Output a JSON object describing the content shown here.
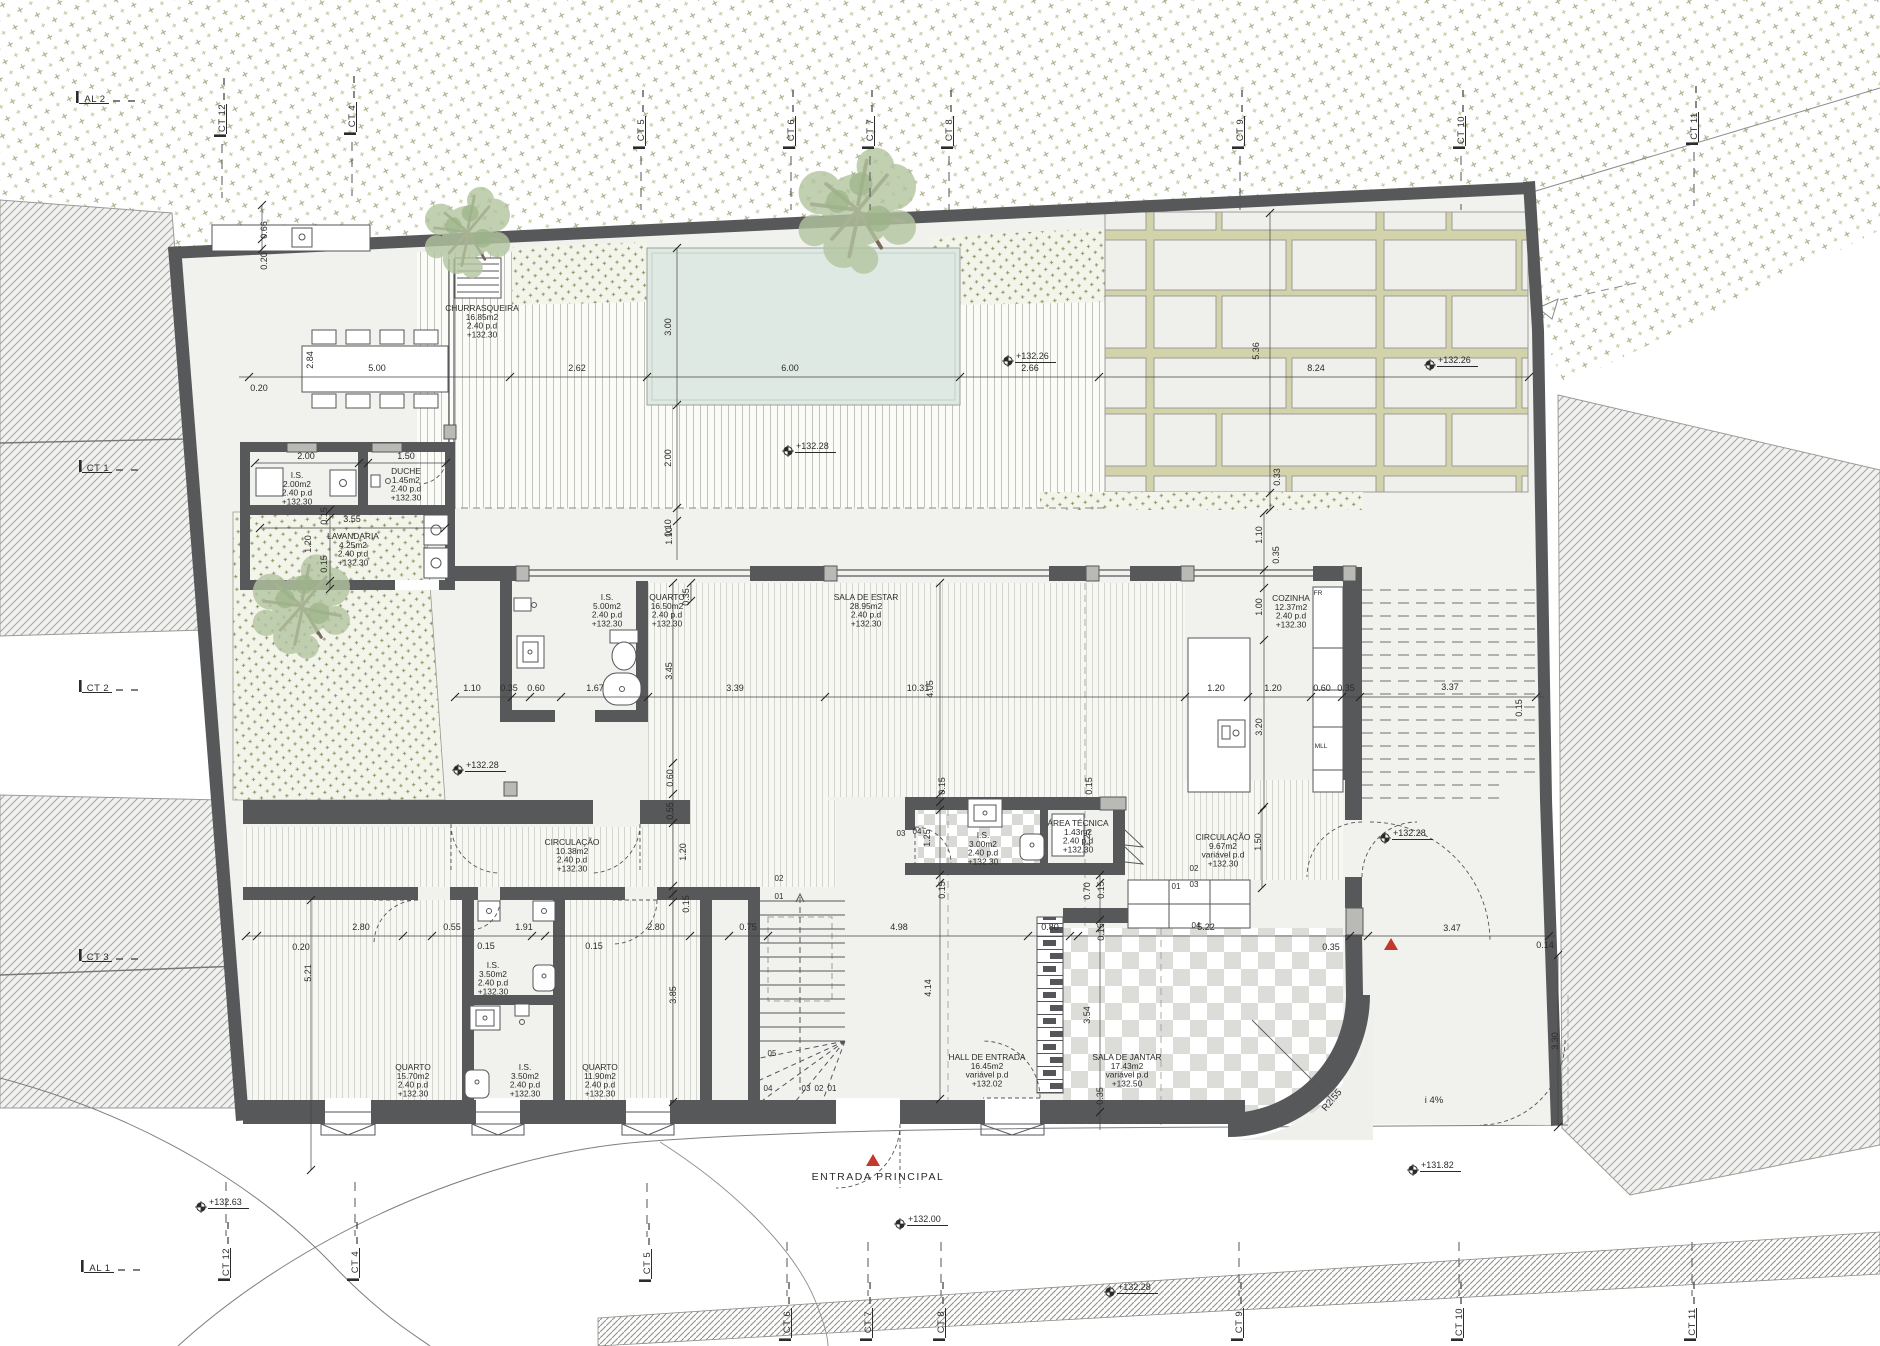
{
  "drawing": {
    "kind": "architectural floor plan",
    "entrance_label": "ENTRADA PRINCIPAL",
    "ramp_slope_label": "i 4%",
    "radius_label": "R2.55"
  },
  "colors": {
    "wall": "#57585a",
    "wall_light": "#b9b9b6",
    "pool": "#dfe9e3",
    "plot_floor": "#f1f1ee",
    "stipple_green": "#8f9465",
    "red_marker": "#c0392b",
    "checker": "#dcdcd8"
  },
  "rooms": [
    {
      "n": "CHURRASQUEIRA",
      "a": "16.85m2",
      "h": "2.40  p.d",
      "l": "+132.30",
      "x": 482,
      "y": 311
    },
    {
      "n": "I.S.",
      "a": "2.00m2",
      "h": "2.40  p.d",
      "l": "+132.30",
      "x": 297,
      "y": 478
    },
    {
      "n": "DUCHE",
      "a": "1.45m2",
      "h": "2.40  p.d",
      "l": "+132.30",
      "x": 406,
      "y": 474
    },
    {
      "n": "LAVANDARIA",
      "a": "4.25m2",
      "h": "2.40  p.d",
      "l": "+132.30",
      "x": 353,
      "y": 539
    },
    {
      "n": "I.S.",
      "a": "5.00m2",
      "h": "2.40  p.d",
      "l": "+132.30",
      "x": 607,
      "y": 600
    },
    {
      "n": "QUARTO",
      "a": "16.50m2",
      "h": "2.40  p.d",
      "l": "+132.30",
      "x": 667,
      "y": 600
    },
    {
      "n": "SALA DE ESTAR",
      "a": "28.95m2",
      "h": "2.40  p.d",
      "l": "+132.30",
      "x": 866,
      "y": 600
    },
    {
      "n": "COZINHA",
      "a": "12.37m2",
      "h": "2.40  p.d",
      "l": "+132.30",
      "x": 1291,
      "y": 601
    },
    {
      "n": "CIRCULAÇÃO",
      "a": "10.38m2",
      "h": "2.40  p.d",
      "l": "+132.30",
      "x": 572,
      "y": 845
    },
    {
      "n": "I.S.",
      "a": "3.00m2",
      "h": "2.40  p.d",
      "l": "+132.30",
      "x": 983,
      "y": 838
    },
    {
      "n": "ÁREA TÉCNICA",
      "a": "1.43m2",
      "h": "2.40  p.d",
      "l": "+132.30",
      "x": 1078,
      "y": 826
    },
    {
      "n": "CIRCULAÇÃO",
      "a": "9.67m2",
      "h": "variável  p.d",
      "l": "+132.30",
      "x": 1223,
      "y": 840
    },
    {
      "n": "QUARTO",
      "a": "15.70m2",
      "h": "2.40  p.d",
      "l": "+132.30",
      "x": 413,
      "y": 1070
    },
    {
      "n": "I.S.",
      "a": "3.50m2",
      "h": "2.40  p.d",
      "l": "+132.30",
      "x": 493,
      "y": 968
    },
    {
      "n": "I.S.",
      "a": "3.50m2",
      "h": "2.40  p.d",
      "l": "+132.30",
      "x": 525,
      "y": 1070
    },
    {
      "n": "QUARTO",
      "a": "11.90m2",
      "h": "2.40  p.d",
      "l": "+132.30",
      "x": 600,
      "y": 1070
    },
    {
      "n": "HALL DE ENTRADA",
      "a": "16.45m2",
      "h": "variável  p.d",
      "l": "+132.02",
      "x": 987,
      "y": 1060
    },
    {
      "n": "SALA DE JANTAR",
      "a": "17.43m2",
      "h": "variável  p.d",
      "l": "+132.50",
      "x": 1127,
      "y": 1060
    }
  ],
  "levels": [
    {
      "t": "+132.26",
      "x": 1008,
      "y": 361
    },
    {
      "t": "+132.26",
      "x": 1430,
      "y": 365
    },
    {
      "t": "+132.28",
      "x": 788,
      "y": 451
    },
    {
      "t": "+132.28",
      "x": 458,
      "y": 770
    },
    {
      "t": "+132.28",
      "x": 1385,
      "y": 838
    },
    {
      "t": "+132.63",
      "x": 201,
      "y": 1207
    },
    {
      "t": "+132.00",
      "x": 900,
      "y": 1224
    },
    {
      "t": "+132.28",
      "x": 1110,
      "y": 1292
    },
    {
      "t": "+131.82",
      "x": 1413,
      "y": 1170
    }
  ],
  "grid_markers": [
    {
      "t": "AL 2",
      "x": 95,
      "y": 99,
      "rot": 0,
      "dash": "right"
    },
    {
      "t": "CT 12",
      "x": 222,
      "y": 118,
      "rot": -90,
      "dash": "down"
    },
    {
      "t": "CT 4",
      "x": 352,
      "y": 116,
      "rot": -90,
      "dash": "down"
    },
    {
      "t": "CT 5",
      "x": 641,
      "y": 130,
      "rot": -90,
      "dash": "down"
    },
    {
      "t": "CT 6",
      "x": 791,
      "y": 130,
      "rot": -90,
      "dash": "down"
    },
    {
      "t": "CT 7",
      "x": 870,
      "y": 130,
      "rot": -90,
      "dash": "down"
    },
    {
      "t": "CT 8",
      "x": 949,
      "y": 130,
      "rot": -90,
      "dash": "down"
    },
    {
      "t": "CT 9",
      "x": 1240,
      "y": 130,
      "rot": -90,
      "dash": "down"
    },
    {
      "t": "CT 10",
      "x": 1461,
      "y": 130,
      "rot": -90,
      "dash": "down"
    },
    {
      "t": "CT 11",
      "x": 1694,
      "y": 126,
      "rot": -90,
      "dash": "down"
    },
    {
      "t": "CT 1",
      "x": 98,
      "y": 468,
      "rot": 0,
      "dash": "right"
    },
    {
      "t": "CT 2",
      "x": 98,
      "y": 688,
      "rot": 0,
      "dash": "right"
    },
    {
      "t": "CT 3",
      "x": 98,
      "y": 957,
      "rot": 0,
      "dash": "right"
    },
    {
      "t": "AL 1",
      "x": 100,
      "y": 1268,
      "rot": 0,
      "dash": "right"
    },
    {
      "t": "CT 12",
      "x": 226,
      "y": 1262,
      "rot": -90,
      "dash": "up"
    },
    {
      "t": "CT 4",
      "x": 355,
      "y": 1262,
      "rot": -90,
      "dash": "up"
    },
    {
      "t": "CT 5",
      "x": 647,
      "y": 1263,
      "rot": -90,
      "dash": "up"
    },
    {
      "t": "CT 6",
      "x": 787,
      "y": 1322,
      "rot": -90,
      "dash": "up"
    },
    {
      "t": "CT 7",
      "x": 868,
      "y": 1322,
      "rot": -90,
      "dash": "up"
    },
    {
      "t": "CT 8",
      "x": 941,
      "y": 1322,
      "rot": -90,
      "dash": "up"
    },
    {
      "t": "CT 9",
      "x": 1239,
      "y": 1322,
      "rot": -90,
      "dash": "up"
    },
    {
      "t": "CT 10",
      "x": 1459,
      "y": 1322,
      "rot": -90,
      "dash": "up"
    },
    {
      "t": "CT 11",
      "x": 1692,
      "y": 1322,
      "rot": -90,
      "dash": "up"
    }
  ],
  "dims": [
    {
      "t": "0.20",
      "x": 259,
      "y": 391
    },
    {
      "t": "2.84",
      "x": 313,
      "y": 360,
      "r": 1
    },
    {
      "t": "5.00",
      "x": 377,
      "y": 371
    },
    {
      "t": "2.62",
      "x": 577,
      "y": 371
    },
    {
      "t": "6.00",
      "x": 790,
      "y": 371
    },
    {
      "t": "2.66",
      "x": 1030,
      "y": 371
    },
    {
      "t": "8.24",
      "x": 1316,
      "y": 371
    },
    {
      "t": "0.66",
      "x": 267,
      "y": 230,
      "r": 1
    },
    {
      "t": "0.20",
      "x": 267,
      "y": 261,
      "r": 1
    },
    {
      "t": "3.00",
      "x": 671,
      "y": 327,
      "r": 1
    },
    {
      "t": "2.00",
      "x": 671,
      "y": 458,
      "r": 1
    },
    {
      "t": "0.10",
      "x": 671,
      "y": 528,
      "r": 1
    },
    {
      "t": "5.36",
      "x": 1259,
      "y": 351,
      "r": 1
    },
    {
      "t": "0.33",
      "x": 1280,
      "y": 477,
      "r": 1
    },
    {
      "t": "2.00",
      "x": 306,
      "y": 459
    },
    {
      "t": "1.50",
      "x": 406,
      "y": 459
    },
    {
      "t": "3.55",
      "x": 352,
      "y": 522
    },
    {
      "t": "0.15",
      "x": 327,
      "y": 516,
      "r": 1
    },
    {
      "t": "1.20",
      "x": 311,
      "y": 544,
      "r": 1
    },
    {
      "t": "0.15",
      "x": 327,
      "y": 564,
      "r": 1
    },
    {
      "t": "1.10",
      "x": 1262,
      "y": 535,
      "r": 1
    },
    {
      "t": "0.35",
      "x": 1279,
      "y": 555,
      "r": 1
    },
    {
      "t": "1.00",
      "x": 1262,
      "y": 607,
      "r": 1
    },
    {
      "t": "3.20",
      "x": 1262,
      "y": 727,
      "r": 1
    },
    {
      "t": "1.10",
      "x": 672,
      "y": 536,
      "r": 1
    },
    {
      "t": "3.45",
      "x": 672,
      "y": 671,
      "r": 1
    },
    {
      "t": "0.35",
      "x": 689,
      "y": 597,
      "r": 1
    },
    {
      "t": "1.10",
      "x": 472,
      "y": 691
    },
    {
      "t": "0.35",
      "x": 509,
      "y": 691
    },
    {
      "t": "0.60",
      "x": 536,
      "y": 691
    },
    {
      "t": "1.67",
      "x": 595,
      "y": 691
    },
    {
      "t": "3.39",
      "x": 735,
      "y": 691
    },
    {
      "t": "10.31",
      "x": 918,
      "y": 691
    },
    {
      "t": "4.05",
      "x": 933,
      "y": 689,
      "r": 1
    },
    {
      "t": "1.20",
      "x": 1216,
      "y": 691
    },
    {
      "t": "1.20",
      "x": 1273,
      "y": 691
    },
    {
      "t": "0.60",
      "x": 1322,
      "y": 691
    },
    {
      "t": "0.35",
      "x": 1346,
      "y": 691
    },
    {
      "t": "3.37",
      "x": 1450,
      "y": 690
    },
    {
      "t": "0.15",
      "x": 1522,
      "y": 708,
      "r": 1
    },
    {
      "t": "0.60",
      "x": 673,
      "y": 778,
      "r": 1
    },
    {
      "t": "0.55",
      "x": 673,
      "y": 811,
      "r": 1
    },
    {
      "t": "1.20",
      "x": 686,
      "y": 852,
      "r": 1
    },
    {
      "t": "0.15",
      "x": 689,
      "y": 904,
      "r": 1
    },
    {
      "t": "0.15",
      "x": 945,
      "y": 786,
      "r": 1
    },
    {
      "t": "0.15",
      "x": 1092,
      "y": 786,
      "r": 1
    },
    {
      "t": "1.25",
      "x": 930,
      "y": 838,
      "r": 1
    },
    {
      "t": "1.25",
      "x": 1090,
      "y": 838,
      "r": 1
    },
    {
      "t": "1.50",
      "x": 1261,
      "y": 842,
      "r": 1
    },
    {
      "t": "0.15",
      "x": 945,
      "y": 890,
      "r": 1
    },
    {
      "t": "0.70",
      "x": 1090,
      "y": 891,
      "r": 1
    },
    {
      "t": "0.15",
      "x": 1104,
      "y": 890,
      "r": 1
    },
    {
      "t": "0.15",
      "x": 1104,
      "y": 932,
      "r": 1
    },
    {
      "t": "3.54",
      "x": 1090,
      "y": 1015,
      "r": 1
    },
    {
      "t": "0.35",
      "x": 1103,
      "y": 1096,
      "r": 1
    },
    {
      "t": "4.14",
      "x": 931,
      "y": 988,
      "r": 1
    },
    {
      "t": "0.20",
      "x": 301,
      "y": 950
    },
    {
      "t": "2.80",
      "x": 361,
      "y": 930
    },
    {
      "t": "0.55",
      "x": 452,
      "y": 930
    },
    {
      "t": "1.91",
      "x": 524,
      "y": 930
    },
    {
      "t": "2.80",
      "x": 656,
      "y": 930
    },
    {
      "t": "0.75",
      "x": 748,
      "y": 930
    },
    {
      "t": "4.98",
      "x": 899,
      "y": 930
    },
    {
      "t": "0.80",
      "x": 1050,
      "y": 930
    },
    {
      "t": "5.22",
      "x": 1206,
      "y": 930
    },
    {
      "t": "0.35",
      "x": 1331,
      "y": 950
    },
    {
      "t": "3.47",
      "x": 1452,
      "y": 931
    },
    {
      "t": "0.14",
      "x": 1545,
      "y": 948
    },
    {
      "t": "5.21",
      "x": 311,
      "y": 973,
      "r": 1
    },
    {
      "t": "0.15",
      "x": 486,
      "y": 949
    },
    {
      "t": "0.15",
      "x": 594,
      "y": 949
    },
    {
      "t": "3.85",
      "x": 676,
      "y": 995,
      "r": 1
    },
    {
      "t": "3.30",
      "x": 1558,
      "y": 1041,
      "r": 1
    }
  ],
  "stair_numbers": [
    {
      "t": "02",
      "x": 779,
      "y": 881
    },
    {
      "t": "01",
      "x": 779,
      "y": 899
    },
    {
      "t": "05",
      "x": 772,
      "y": 1056
    },
    {
      "t": "04",
      "x": 768,
      "y": 1091
    },
    {
      "t": "03",
      "x": 806,
      "y": 1091
    },
    {
      "t": "02",
      "x": 819,
      "y": 1091
    },
    {
      "t": "01",
      "x": 832,
      "y": 1091
    },
    {
      "t": "03",
      "x": 901,
      "y": 836
    },
    {
      "t": "04",
      "x": 917,
      "y": 834
    },
    {
      "t": "01",
      "x": 1176,
      "y": 889
    },
    {
      "t": "02",
      "x": 1194,
      "y": 871
    },
    {
      "t": "03",
      "x": 1194,
      "y": 887
    },
    {
      "t": "04",
      "x": 1196,
      "y": 928
    }
  ],
  "small_labels": [
    {
      "t": "FR",
      "x": 1318,
      "y": 595
    },
    {
      "t": "MLL",
      "x": 1321,
      "y": 748
    }
  ],
  "annotations": [
    {
      "t": "ENTRADA  PRINCIPAL",
      "x": 878,
      "y": 1180,
      "cls": "ann"
    },
    {
      "t": "i  4%",
      "x": 1434,
      "y": 1103,
      "cls": "ann2"
    },
    {
      "t": "R2.55",
      "x": 1334,
      "y": 1102,
      "cls": "ann2",
      "rot": -50
    }
  ]
}
